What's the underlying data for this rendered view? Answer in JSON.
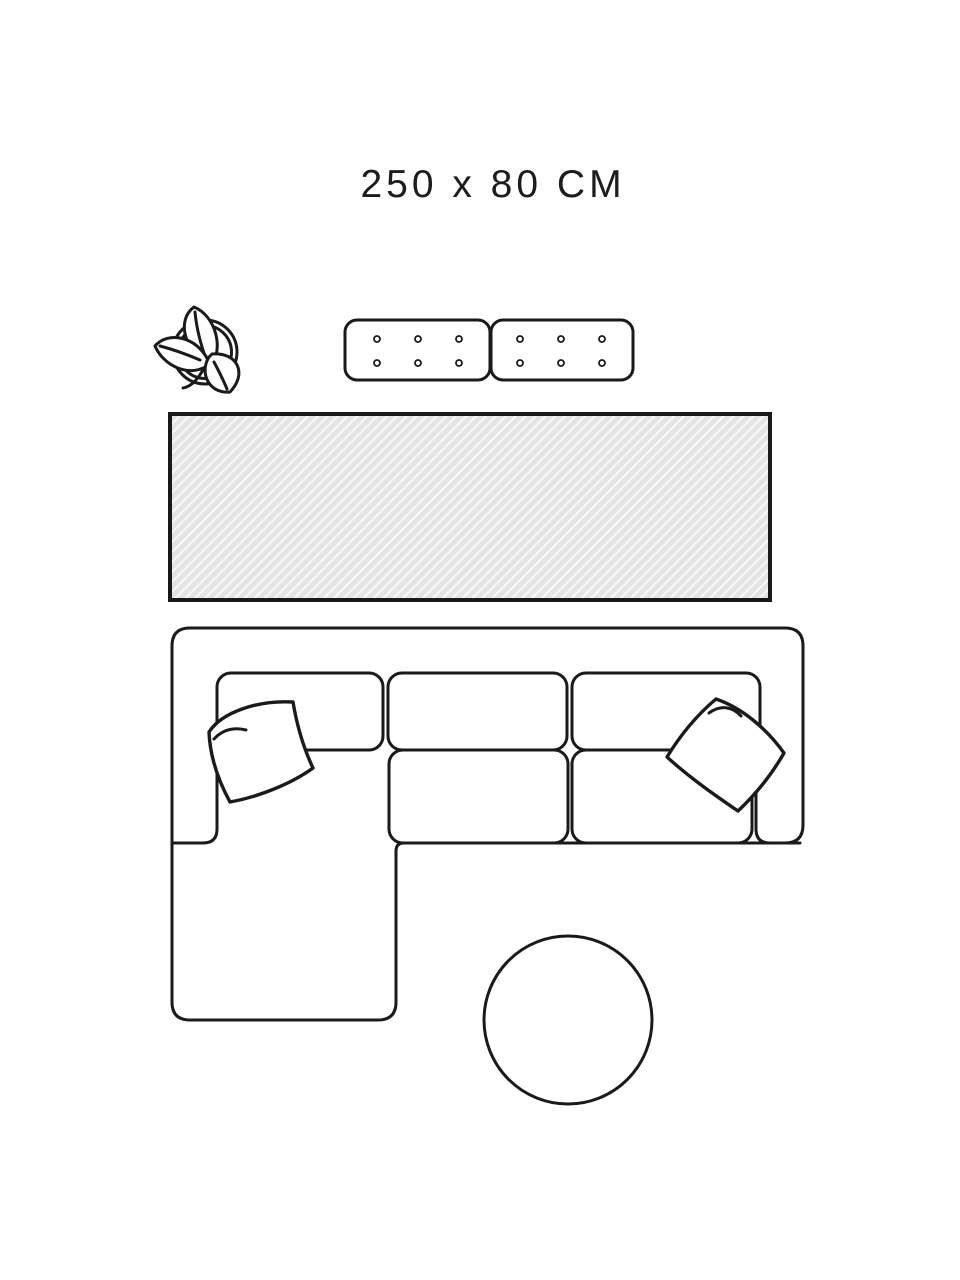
{
  "size_label": "250 x 80 CM",
  "colors": {
    "line": "#1a1a1a",
    "text": "#1c1c1c",
    "background": "#ffffff",
    "rug_fill": "#e4e4e4",
    "rug_stripe": "#f8f8f8",
    "rug_border": "#191919"
  },
  "illustration": {
    "type": "room-plan-top-view",
    "highlighted_item": "runner-rug",
    "rug_size_cm": {
      "width": 250,
      "depth": 80
    },
    "items": [
      "potted-plant",
      "sideboard-two-modules",
      "runner-rug-hatched",
      "corner-sofa-with-chaise",
      "back-cushions",
      "seat-cushions",
      "throw-pillow-left",
      "throw-pillow-right",
      "round-side-table"
    ]
  }
}
